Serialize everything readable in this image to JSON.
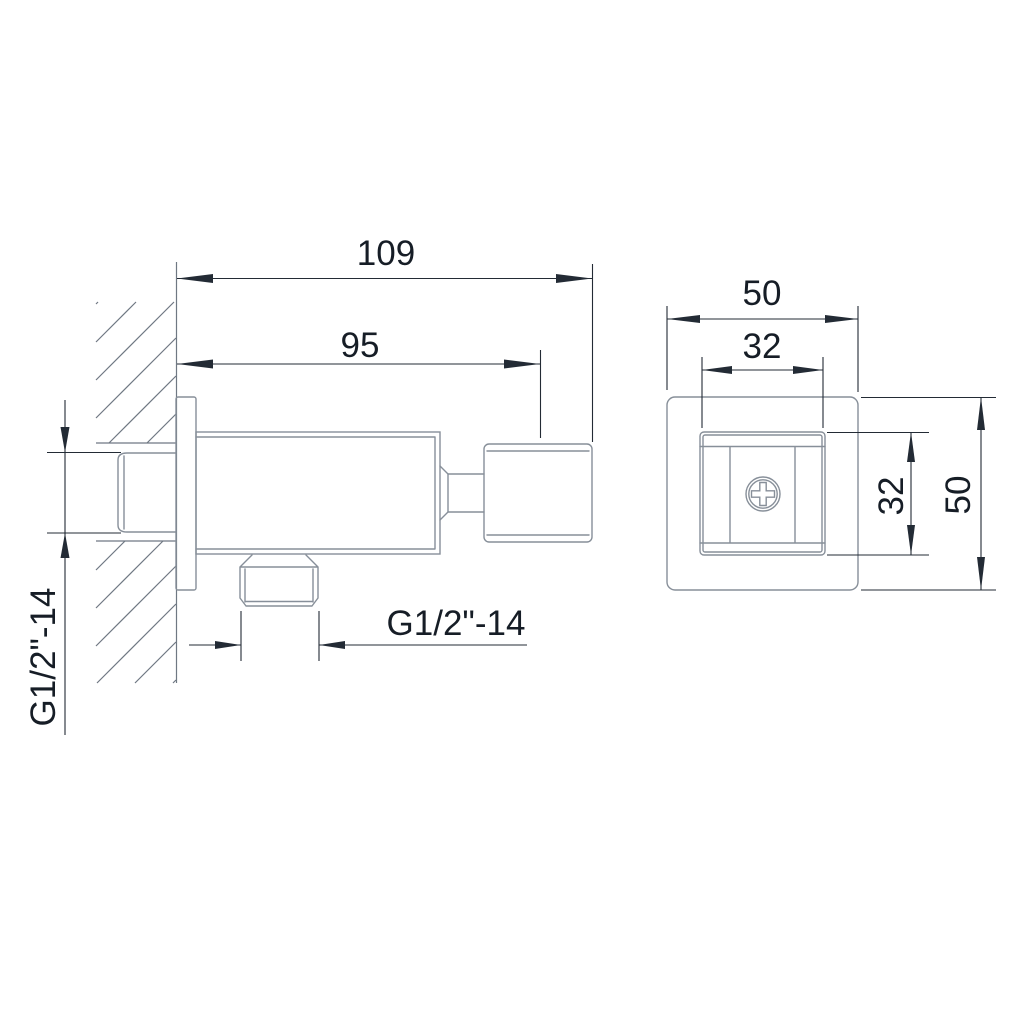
{
  "title": "Wall-mounted square shower outlet elbow - dimension drawing",
  "views": {
    "side_view": {
      "dim_width_total": "109",
      "dim_width_body": "95",
      "thread_label_inlet": "G1/2\"-14",
      "thread_label_outlet": "G1/2\"-14"
    },
    "front_view": {
      "dim_outer_width": "50",
      "dim_inner_width": "32",
      "dim_inner_height": "32",
      "dim_outer_height": "50"
    }
  },
  "colors": {
    "background": "#ffffff",
    "object_line": "#878f99",
    "hatch_line": "#6f7883",
    "dimension_line": "#232b35",
    "text": "#161d26"
  }
}
